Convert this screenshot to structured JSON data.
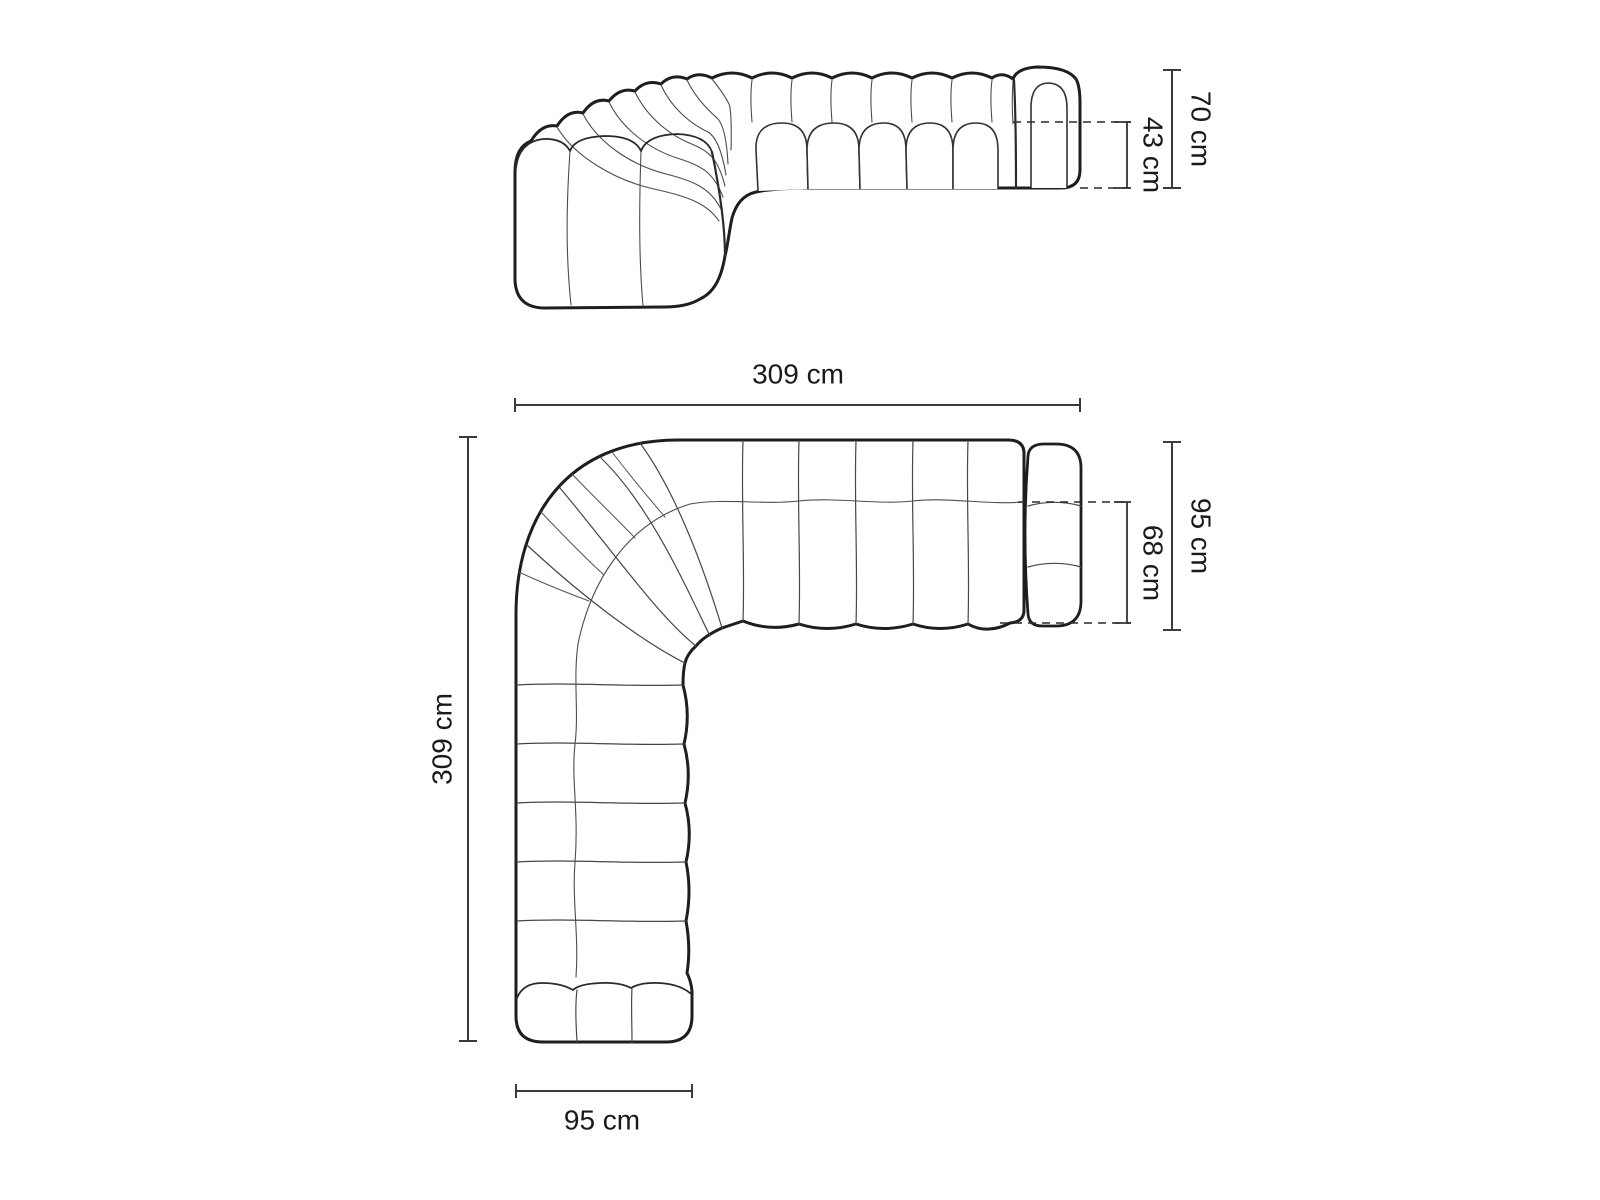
{
  "diagram": {
    "subject": "modular corner sofa dimension drawing",
    "colors": {
      "background": "#ffffff",
      "outline": "#1e1e1e",
      "thin_line": "#4d4d4d",
      "dimension_line": "#3a3a3a",
      "label_text": "#1a1a1a"
    },
    "front_view": {
      "name": "front elevation",
      "dims": {
        "total_height": {
          "label": "70 cm",
          "orientation": "vertical-right"
        },
        "seat_height": {
          "label": "43 cm",
          "orientation": "vertical-right"
        },
        "total_width": {
          "label": "309 cm",
          "orientation": "horizontal-below"
        }
      }
    },
    "top_view": {
      "name": "top plan view",
      "dims": {
        "total_depth": {
          "label": "95 cm",
          "orientation": "vertical-right"
        },
        "seat_depth": {
          "label": "68 cm",
          "orientation": "vertical-right"
        },
        "total_length": {
          "label": "309 cm",
          "orientation": "vertical-left"
        },
        "end_width": {
          "label": "95 cm",
          "orientation": "horizontal-below"
        }
      }
    }
  }
}
